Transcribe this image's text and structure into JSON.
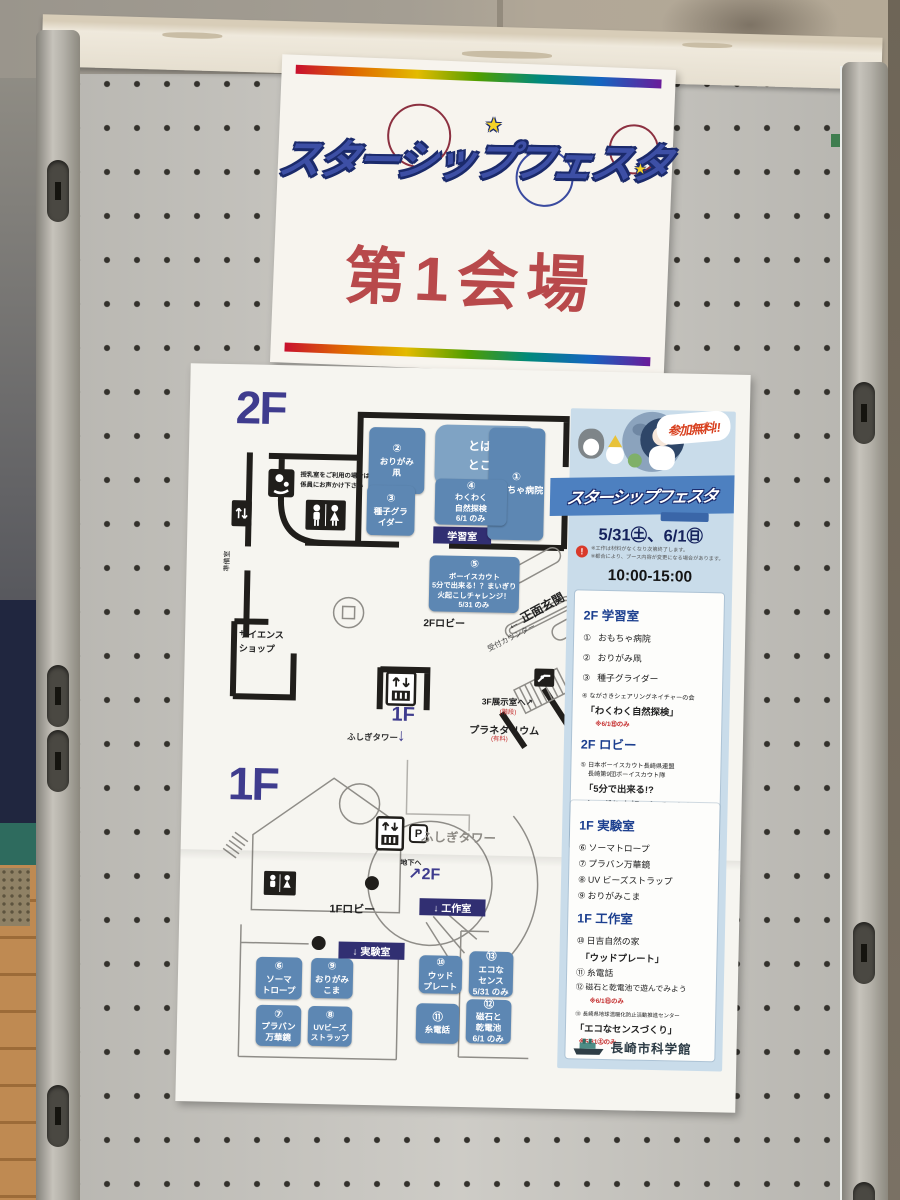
{
  "title_poster": {
    "logo_text": "スターシップフェスタ",
    "venue_label": "第1会場"
  },
  "map_poster": {
    "floor2_label": "2F",
    "floor1_label": "1F",
    "nursing_note_line1": "授乳室をご利用の場合は",
    "nursing_note_line2": "係員にお声かけ下さい",
    "prep_room_label": "準備室",
    "science_shop_line1": "サイエンス",
    "science_shop_line2": "ショップ",
    "learning_room_label": "学習室",
    "lobby2f_label": "2Fロビー",
    "entrance_label": "← 正面玄関",
    "reception_label": "受付カウンター",
    "to_3f_label": "3F展示室へ↗",
    "to_3f_note": "(階段)",
    "planetarium_label": "プラネタリウム",
    "planetarium_note": "(有料)",
    "mid_floor_label": "1F",
    "mid_floor_arrow": "↓",
    "fushigi_tower_label": "ふしぎタワー",
    "fushigi_tower_label2": "ふしぎタワー",
    "basement_label": "地下へ",
    "to_2f_label": "↗2F",
    "lobby1f_label": "1Fロビー",
    "workshop_label": "↓ 工作室",
    "lab_label": "↓ 実験室",
    "parking_label": "P",
    "open2f": {
      "lines": [
        "とばす",
        "ところ"
      ]
    },
    "booths2f": [
      {
        "num": "②",
        "lines": [
          "おりがみ",
          "凧"
        ]
      },
      {
        "num": "①",
        "lines": [
          "おもちゃ病院"
        ]
      },
      {
        "num": "③",
        "lines": [
          "種子グラ",
          "イダー"
        ]
      },
      {
        "num": "④",
        "lines": [
          "わくわく",
          "自然探検",
          "6/1 のみ"
        ]
      },
      {
        "num": "⑤",
        "lines": [
          "ボーイスカウト",
          "5分で出来る！？まいぎり",
          "火起こしチャレンジ！",
          "5/31 のみ"
        ]
      }
    ],
    "booths1f": [
      {
        "num": "⑥",
        "lines": [
          "ソーマ",
          "トロープ"
        ]
      },
      {
        "num": "⑨",
        "lines": [
          "おりがみ",
          "こま"
        ]
      },
      {
        "num": "⑦",
        "lines": [
          "プラバン",
          "万華鏡"
        ]
      },
      {
        "num": "⑧",
        "lines": [
          "UVビーズ",
          "ストラップ"
        ]
      },
      {
        "num": "⑩",
        "lines": [
          "ウッド",
          "プレート"
        ]
      },
      {
        "num": "⑬",
        "lines": [
          "エコな",
          "センス",
          "5/31 のみ"
        ]
      },
      {
        "num": "⑪",
        "lines": [
          "糸電話"
        ]
      },
      {
        "num": "⑫",
        "lines": [
          "磁石と",
          "乾電池",
          "6/1 のみ"
        ]
      }
    ]
  },
  "sidebar": {
    "free_badge": "参加無料!!",
    "logo_text": "スターシップフェスタ",
    "dates": "5/31㊏、6/1㊐",
    "note1": "※工作は材料がなくなり次第終了します。",
    "note2": "※都合により、ブース内容が変更になる場合があります。",
    "time": "10:00-15:00",
    "s2f_learning": {
      "heading": "2F 学習室",
      "items": [
        {
          "num": "①",
          "text": "おもちゃ病院"
        },
        {
          "num": "②",
          "text": "おりがみ凧"
        },
        {
          "num": "③",
          "text": "種子グライダー"
        },
        {
          "num": "④",
          "text": "ながさきシェアリングネイチャーの会"
        }
      ],
      "item4_sub": "「わくわく自然探検」",
      "item4_note": "※6/1㊐のみ"
    },
    "s2f_lobby": {
      "heading": "2F ロビー",
      "item5_num": "⑤",
      "item5_org1": "日本ボーイスカウト長崎県連盟",
      "item5_org2": "長崎第9団ボーイスカウト隊",
      "item5_sub1": "「5分で出来る!?",
      "item5_sub2": "まいぎり火起こしチャレンジ！」",
      "item5_note": "※5/31㊏のみ"
    },
    "s1f_lab": {
      "heading": "1F 実験室",
      "items": [
        {
          "num": "⑥",
          "text": "ソーマトロープ"
        },
        {
          "num": "⑦",
          "text": "プラバン万華鏡"
        },
        {
          "num": "⑧",
          "text": "UV ビーズストラップ"
        },
        {
          "num": "⑨",
          "text": "おりがみこま"
        }
      ]
    },
    "s1f_workshop": {
      "heading": "1F 工作室",
      "item10_num": "⑩",
      "item10_text": "日吉自然の家",
      "item10_sub": "「ウッドプレート」",
      "item11_num": "⑪",
      "item11_text": "糸電話",
      "item12_num": "⑫",
      "item12_text": "磁石と乾電池で遊んでみよう",
      "item12_note": "※6/1㊐のみ",
      "item13_num": "⑬",
      "item13_text": "長崎県地球温暖化防止活動推進センター",
      "item13_sub": "「エコなセンスづくり」",
      "item13_note": "※5/31㊏のみ"
    },
    "org_name": "長崎市科学館"
  }
}
